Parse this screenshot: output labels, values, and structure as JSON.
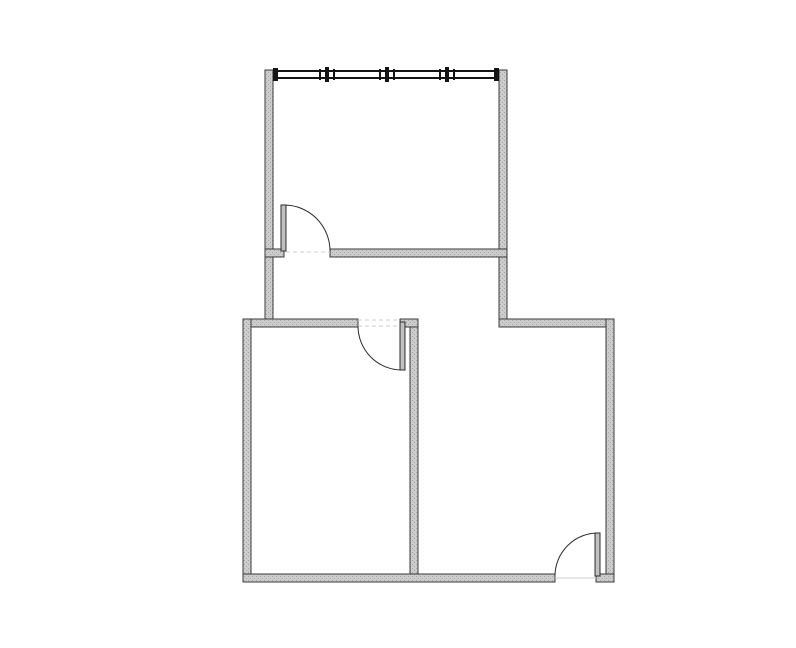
{
  "canvas": {
    "width": 796,
    "height": 648,
    "background": "#ffffff"
  },
  "palette": {
    "wall_fill": "#cccccc",
    "wall_speckle": "#a6a6a6",
    "wall_edge": "#3a3a3a",
    "window_frame": "#141414",
    "door_line": "#2b2b2b",
    "door_leaf_fill": "#c0c0c0",
    "threshold_line": "#cccccc"
  },
  "floor_plan": {
    "walls": [
      {
        "id": "top-room-left-wall",
        "x": 265,
        "y": 70,
        "w": 8,
        "h": 257
      },
      {
        "id": "top-room-right-wall",
        "x": 499,
        "y": 70,
        "w": 8,
        "h": 257
      },
      {
        "id": "top-room-bottom-wall-stub",
        "x": 265,
        "y": 249,
        "w": 19,
        "h": 8
      },
      {
        "id": "top-room-bottom-wall",
        "x": 330,
        "y": 249,
        "w": 177,
        "h": 8
      },
      {
        "id": "lower-section-top-wall-left",
        "x": 243,
        "y": 319,
        "w": 115,
        "h": 8
      },
      {
        "id": "lower-section-top-wall-hinge-stub",
        "x": 400,
        "y": 319,
        "w": 18,
        "h": 8
      },
      {
        "id": "lower-section-top-wall-right",
        "x": 499,
        "y": 319,
        "w": 115,
        "h": 8
      },
      {
        "id": "lower-section-left-wall",
        "x": 243,
        "y": 319,
        "w": 8,
        "h": 263
      },
      {
        "id": "interior-dividing-wall",
        "x": 410,
        "y": 327,
        "w": 8,
        "h": 255
      },
      {
        "id": "lower-section-right-wall",
        "x": 606,
        "y": 319,
        "w": 8,
        "h": 263
      },
      {
        "id": "bottom-wall",
        "x": 243,
        "y": 574,
        "w": 312,
        "h": 8
      },
      {
        "id": "bottom-wall-hinge-stub",
        "x": 596,
        "y": 574,
        "w": 18,
        "h": 8
      }
    ],
    "window_wall": {
      "id": "top-window-wall",
      "x1": 273,
      "x2": 499,
      "y": 70,
      "band_h": 9,
      "frame_line_h": 2,
      "end_plate_w": 5,
      "mullions": [
        327,
        387,
        447
      ]
    },
    "doors": [
      {
        "id": "top-room-door",
        "leaf": {
          "x": 281,
          "y": 205,
          "w": 5,
          "h": 46
        },
        "arc": {
          "x1": 284,
          "y1": 205,
          "r": 46,
          "sweep": 1,
          "x2": 330,
          "y2": 251
        },
        "thresholds": [
          {
            "x1": 286,
            "y1": 252,
            "x2": 330,
            "y2": 252,
            "dash": "4 3"
          }
        ]
      },
      {
        "id": "bottom-left-room-door",
        "leaf": {
          "x": 400,
          "y": 322,
          "w": 5,
          "h": 48
        },
        "arc": {
          "x1": 358,
          "y1": 326,
          "r": 44,
          "sweep": 0,
          "x2": 402,
          "y2": 370
        },
        "thresholds": [
          {
            "x1": 358,
            "y1": 320,
            "x2": 400,
            "y2": 320,
            "dash": "4 3"
          },
          {
            "x1": 358,
            "y1": 326,
            "x2": 400,
            "y2": 326,
            "dash": "4 3"
          }
        ]
      },
      {
        "id": "bottom-right-room-door",
        "leaf": {
          "x": 595,
          "y": 533,
          "w": 5,
          "h": 43
        },
        "arc": {
          "x1": 598,
          "y1": 533,
          "r": 43,
          "sweep": 0,
          "x2": 555,
          "y2": 576
        },
        "thresholds": [
          {
            "x1": 555,
            "y1": 578,
            "x2": 596,
            "y2": 578,
            "dash": null
          }
        ]
      }
    ]
  }
}
